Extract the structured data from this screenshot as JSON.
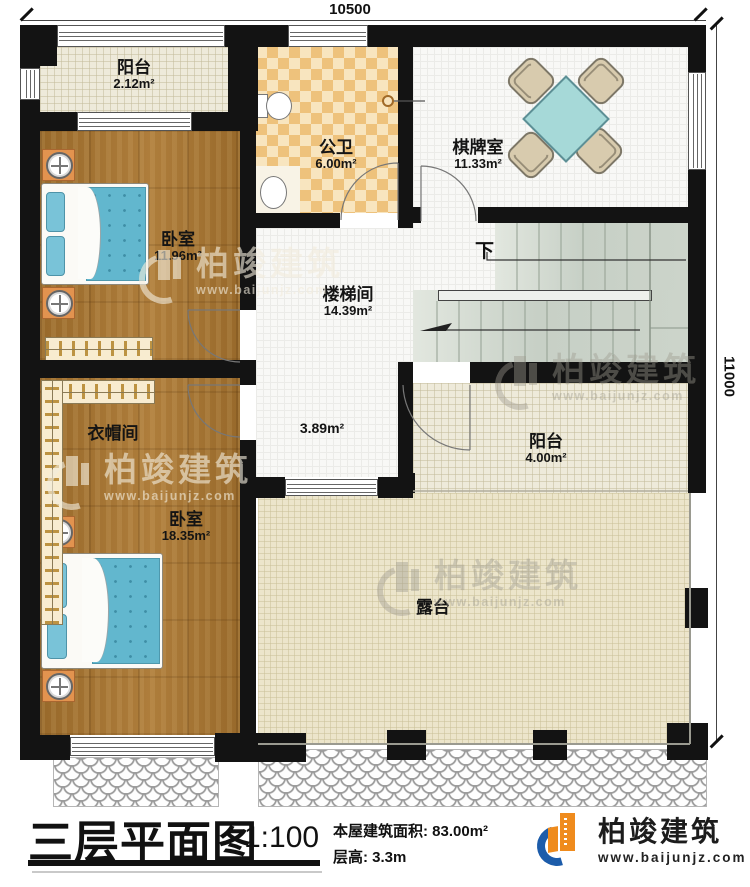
{
  "dimensions": {
    "top": "10500",
    "right": "11000"
  },
  "rooms": {
    "balcony1": {
      "name": "阳台",
      "area": "2.12m²"
    },
    "bathroom": {
      "name": "公卫",
      "area": "6.00m²"
    },
    "chess_room": {
      "name": "棋牌室",
      "area": "11.33m²"
    },
    "bedroom1": {
      "name": "卧室",
      "area": "11.96m²"
    },
    "stairwell": {
      "name": "楼梯间",
      "area": "14.39m²"
    },
    "hall": {
      "area": "3.89m²"
    },
    "cloakroom": {
      "name": "衣帽间"
    },
    "balcony2": {
      "name": "阳台",
      "area": "4.00m²"
    },
    "bedroom2": {
      "name": "卧室",
      "area": "18.35m²"
    },
    "terrace": {
      "name": "露台"
    }
  },
  "stairs": {
    "down_label": "下"
  },
  "watermark": {
    "brand": "柏竣建筑",
    "url": "www.baijunjz.com"
  },
  "title_block": {
    "title": "三层平面图",
    "scale": "1:100",
    "building_area": "本屋建筑面积: 83.00m²",
    "floor_height": "层高: 3.3m"
  },
  "logo": {
    "brand": "柏竣建筑",
    "url": "www.baijunjz.com"
  },
  "colors": {
    "wall": "#131313",
    "logo_orange": "#ef8b1d",
    "logo_blue": "#1c5caa",
    "wood_floor": "#a9752f",
    "table_teal": "#a6d9d8"
  }
}
